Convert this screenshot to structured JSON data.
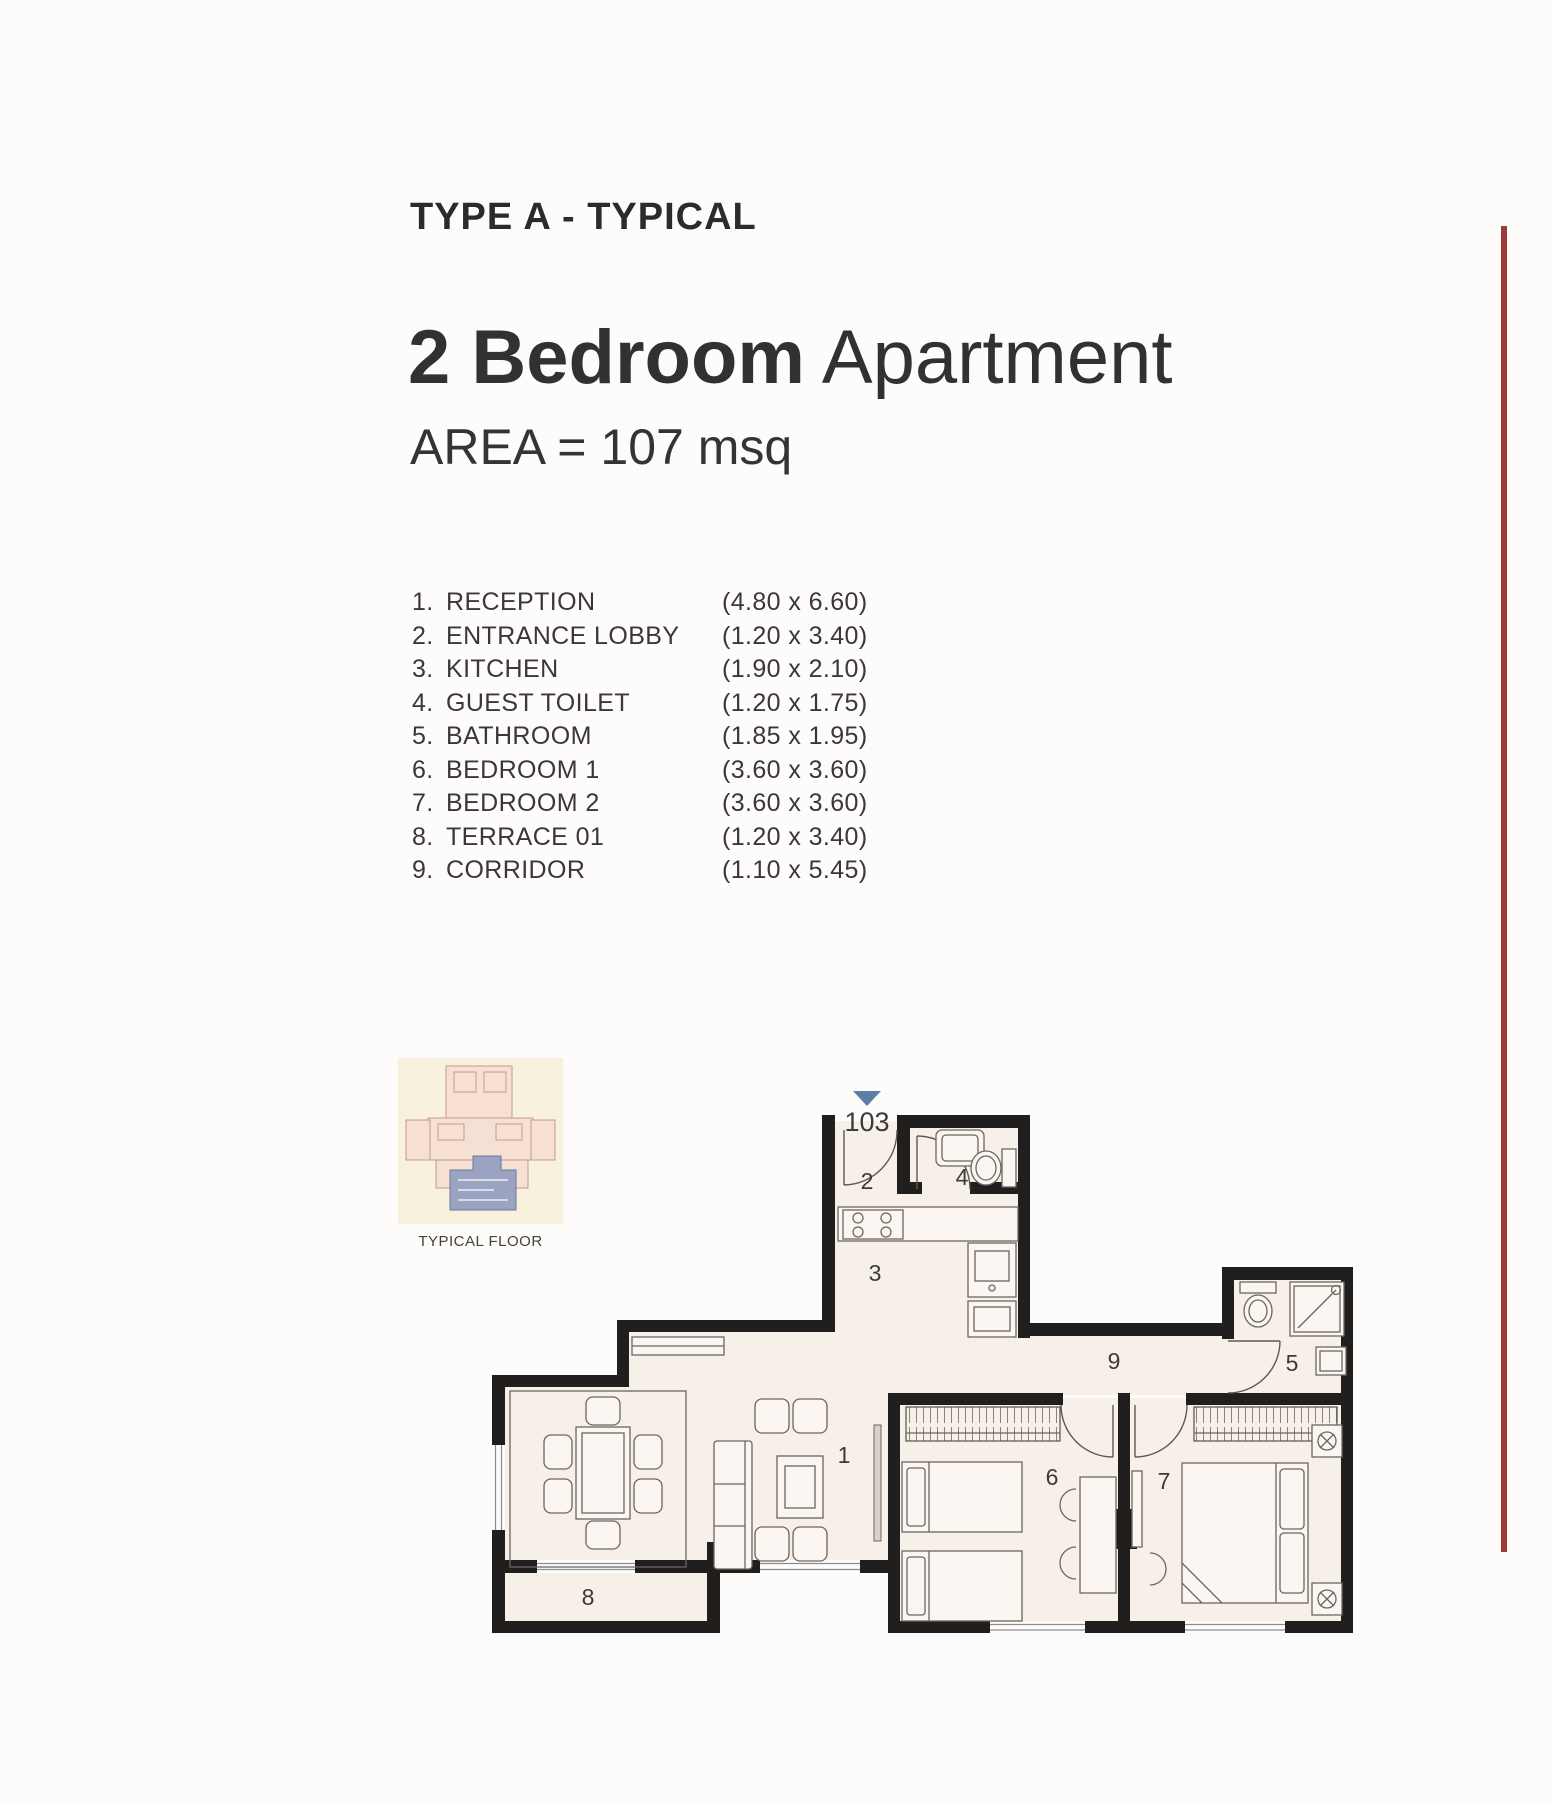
{
  "header": {
    "type_label": "TYPE A - TYPICAL",
    "title_bold": "2 Bedroom",
    "title_light": " Apartment",
    "area": "AREA = 107 msq"
  },
  "room_list": [
    {
      "num": "1.",
      "name": "RECEPTION",
      "dims": "(4.80 x 6.60)"
    },
    {
      "num": "2.",
      "name": "ENTRANCE LOBBY",
      "dims": "(1.20 x 3.40)"
    },
    {
      "num": "3.",
      "name": "KITCHEN",
      "dims": "(1.90 x 2.10)"
    },
    {
      "num": "4.",
      "name": "GUEST TOILET",
      "dims": "(1.20 x 1.75)"
    },
    {
      "num": "5.",
      "name": "BATHROOM",
      "dims": "(1.85 x 1.95)"
    },
    {
      "num": "6.",
      "name": "BEDROOM 1",
      "dims": "(3.60 x 3.60)"
    },
    {
      "num": "7.",
      "name": "BEDROOM 2",
      "dims": "(3.60 x 3.60)"
    },
    {
      "num": "8.",
      "name": "TERRACE 01",
      "dims": "(1.20 x 3.40)"
    },
    {
      "num": "9.",
      "name": "CORRIDOR",
      "dims": "(1.10 x 5.45)"
    }
  ],
  "thumbnail": {
    "caption": "TYPICAL FLOOR"
  },
  "floor_plan": {
    "unit_number": "103",
    "labels": {
      "reception": "1",
      "entrance_lobby": "2",
      "kitchen": "3",
      "guest_toilet": "4",
      "bathroom": "5",
      "bedroom1": "6",
      "bedroom2": "7",
      "terrace": "8",
      "corridor": "9"
    }
  },
  "colors": {
    "accent_line": "#9e3a3a",
    "wall": "#211e1e",
    "floor": "#f7f0e9",
    "entry_marker": "#5d7fa6"
  }
}
